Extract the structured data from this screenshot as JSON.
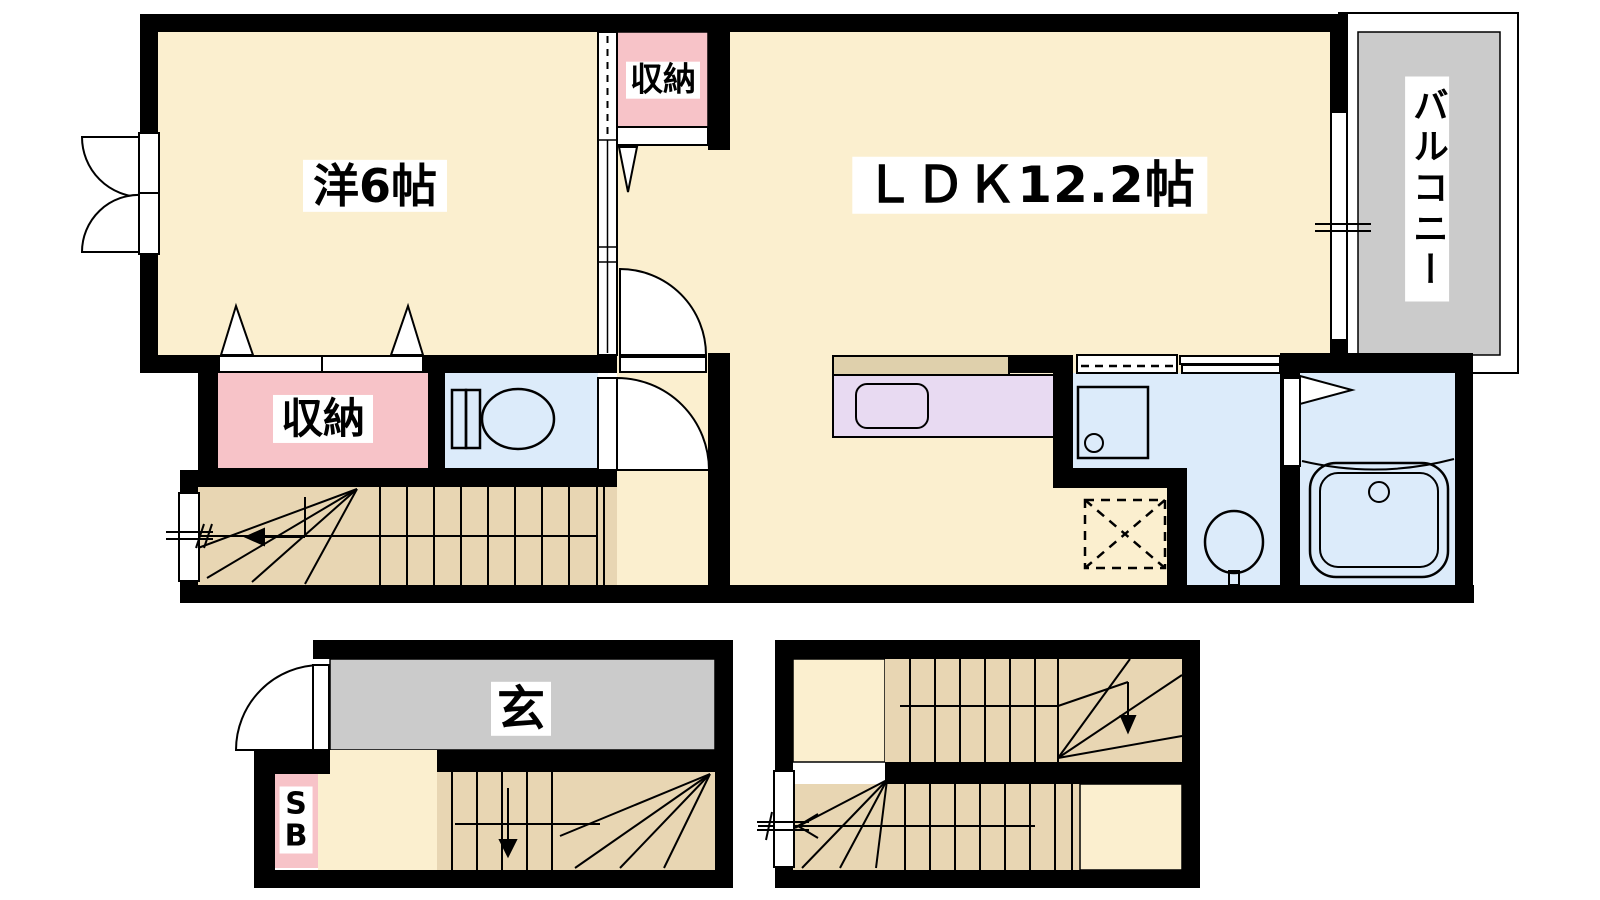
{
  "labels": {
    "western_room": "洋6帖",
    "ldk": "ＬＤＫ12.2帖",
    "closet_upper": "収納",
    "closet_lower": "収納",
    "balcony": "バルコニー",
    "entrance": "玄",
    "shoe_box": "S\nB"
  },
  "palette": {
    "wall": "#000000",
    "room_floor_cream": "#FBEFCF",
    "stairs_tan": "#E8D6B3",
    "closet_pink": "#F7C3C8",
    "wet_area_blue": "#DCEBFA",
    "kitchen_lavender": "#E8DAF2",
    "kitchen_counter_beige": "#DFD0AC",
    "entrance_gray": "#CBCBCB",
    "balcony_gray": "#CBCBCB",
    "label_background": "#FFFFFF",
    "line": "#000000"
  }
}
